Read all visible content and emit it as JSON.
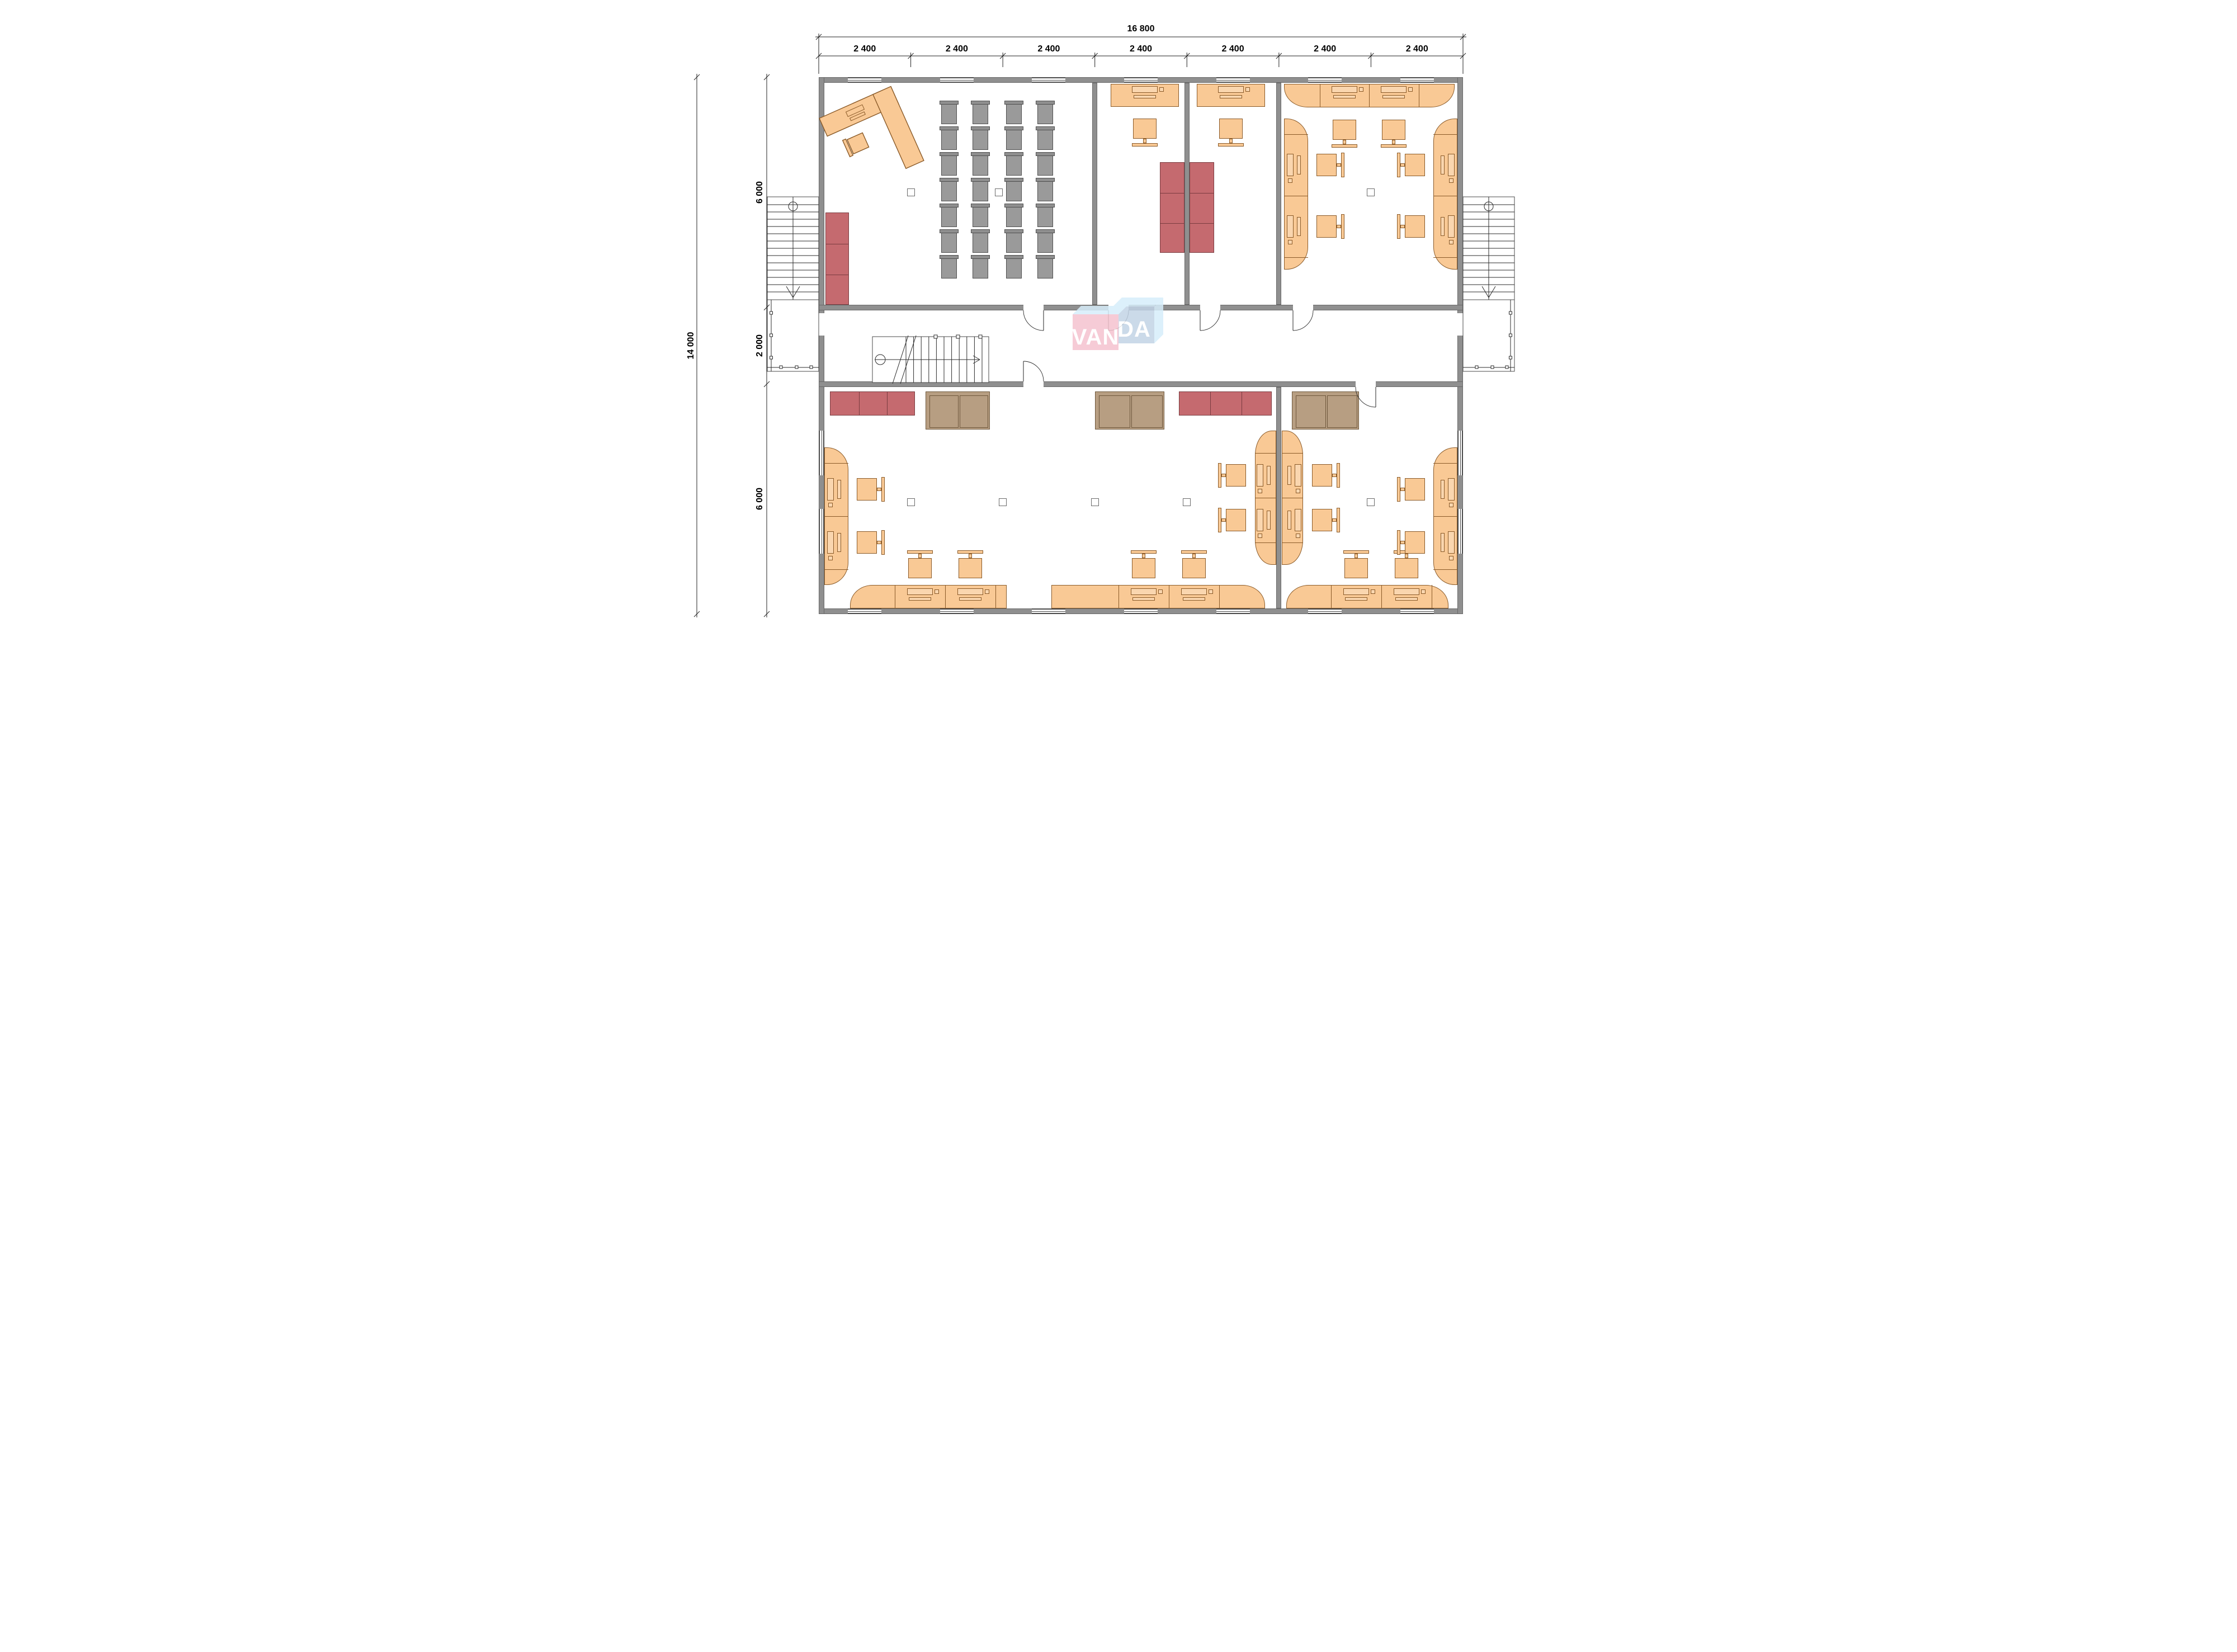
{
  "page": {
    "type": "architectural-floor-plan",
    "background": "#ffffff"
  },
  "logo": {
    "text": "VANDA",
    "part1": "VAN",
    "part2": "DA"
  },
  "dimensions": {
    "width_total": "16 800",
    "width_segments": [
      "2 400",
      "2 400",
      "2 400",
      "2 400",
      "2 400",
      "2 400",
      "2 400"
    ],
    "height_total": "14 000",
    "height_segments": [
      "6 000",
      "2 000",
      "6 000"
    ]
  },
  "colors": {
    "wall": "#8f8f8f",
    "desk_fill": "#f9c995",
    "desk_stroke": "#8a5a28",
    "seat_gray": "#9a9a9a",
    "cabinet_red": "#c56a6f",
    "sofa_brown": "#b79e82",
    "logo_pink": "#f5c3cf",
    "logo_blue": "#c2d4e6",
    "logo_light": "#d7eefb",
    "line": "#333333"
  }
}
